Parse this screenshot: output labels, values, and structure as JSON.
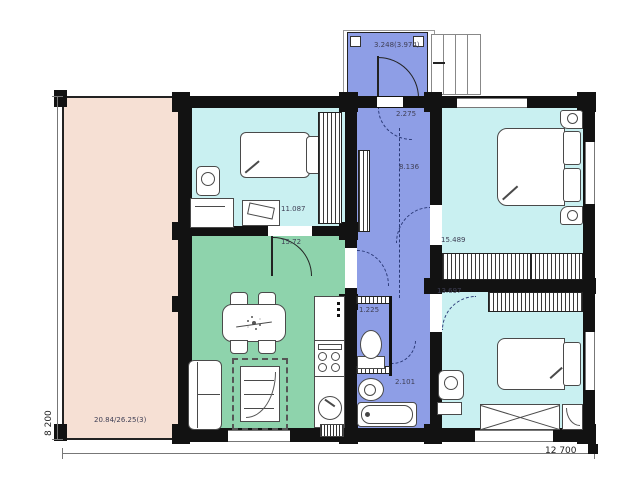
{
  "title": "timber house floor plan",
  "palette": {
    "terrace_pink": "#f6e0d4",
    "room_cyan": "#c9f0f1",
    "room_green": "#8ed3ac",
    "room_blue": "#8e9ee6",
    "wall_black": "#121212",
    "outline_gray": "#4a4a4a"
  },
  "dimensions": {
    "overall_width": "12 700",
    "overall_height": "8 200"
  },
  "rooms": {
    "porch": {
      "area": "3.248(3.974)"
    },
    "terrace": {
      "area": "20.84/26.25(3)"
    },
    "bedroom_top": {
      "area": "11.087"
    },
    "living": {
      "area": "15.72"
    },
    "hall_entry": {
      "area": "2.275"
    },
    "hall": {
      "area": "8.136"
    },
    "wc": {
      "area": "1.225"
    },
    "bath_lobby": {
      "area": "2.101"
    },
    "bedroom_right_top": {
      "area": "15.489"
    },
    "bedroom_right_bottom": {
      "area": "13.697"
    }
  }
}
